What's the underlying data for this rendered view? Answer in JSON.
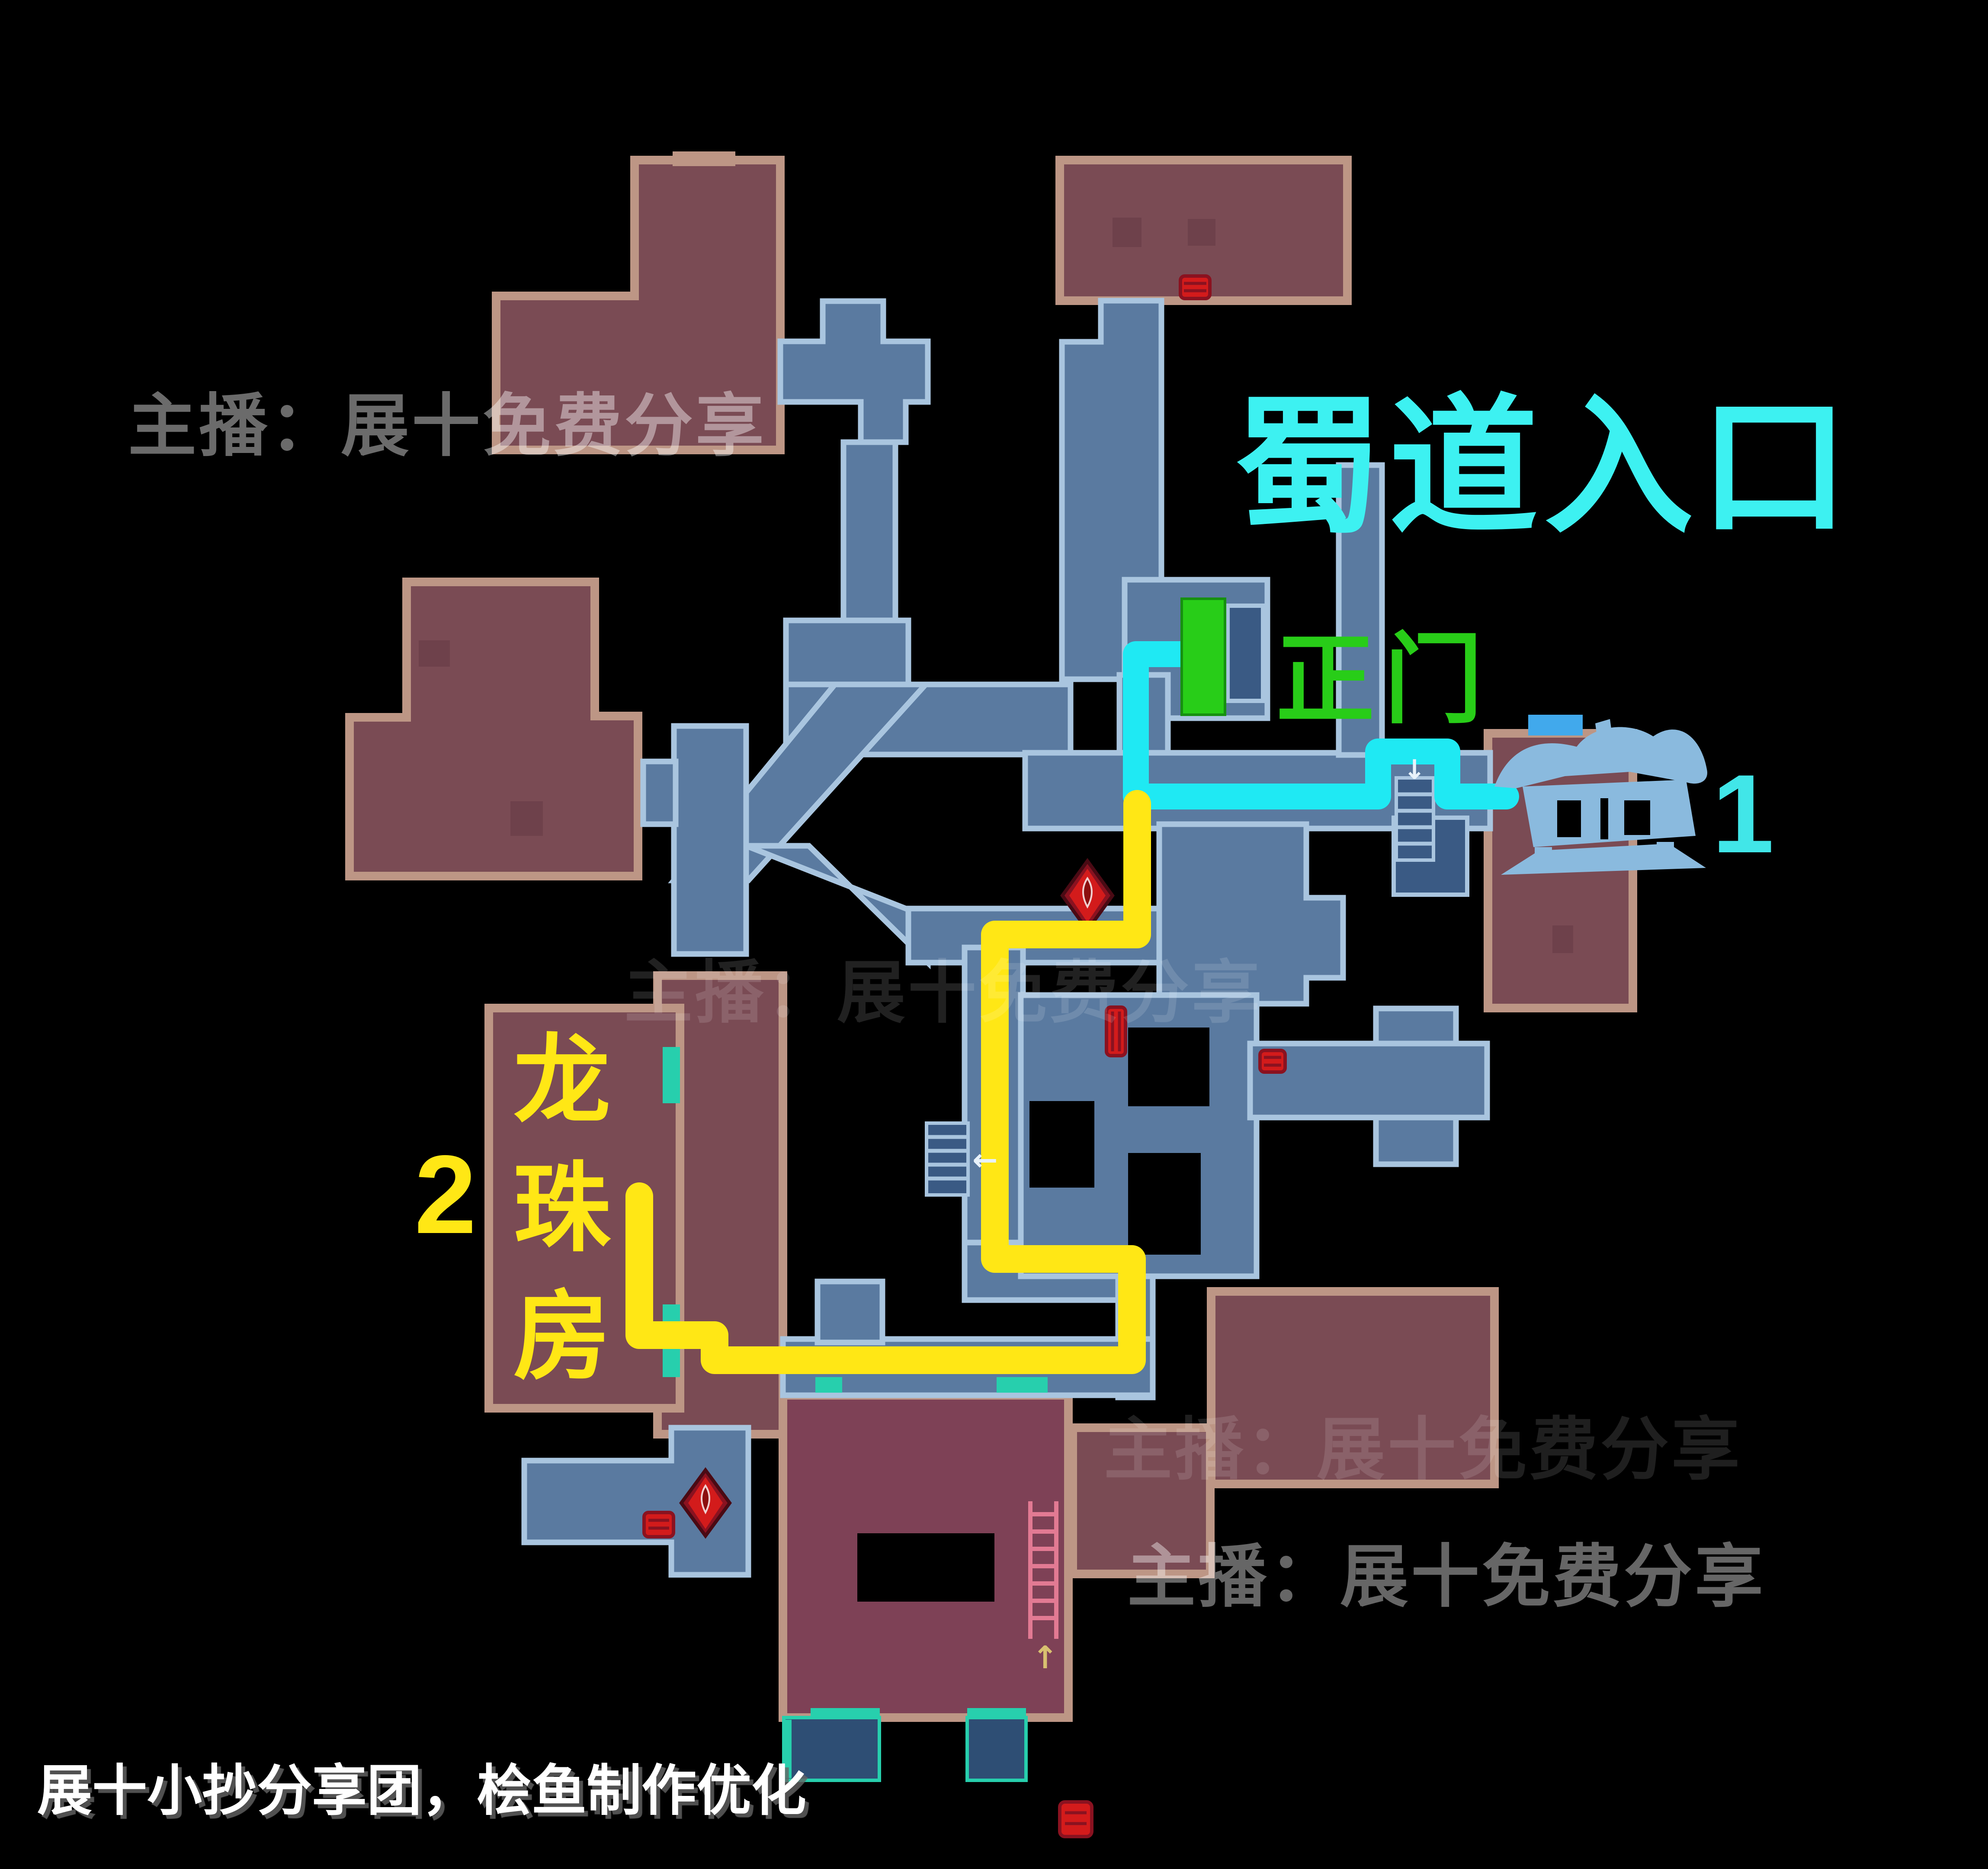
{
  "colors": {
    "bg": "#000000",
    "roomRed": "#7a4b54",
    "roomRedDeep": "#7e4156",
    "roomRedDark": "#6e414b",
    "wallTan": "#bd9685",
    "roomBlue": "#5a7aa0",
    "roomBlueDark": "#3a5a84",
    "roomBlueDeep": "#2e4e74",
    "wallBlue": "#a9c5df",
    "brightBlue": "#41a9ec",
    "teal": "#27cfad",
    "cyan": "#1fe9f3",
    "titleCyan": "#3df1f1",
    "numCyan": "#41e6e8",
    "yellow": "#ffe715",
    "green": "#28cd18",
    "red": "#d31b1b",
    "redDark": "#8a1220",
    "lantern": "#8abade",
    "ladderPink": "#e27a93"
  },
  "title": "蜀道入口",
  "gate_label": "正门",
  "marker1_label": "1",
  "marker2_label": "2",
  "room_label": {
    "full": "龙珠房",
    "chars": [
      "龙",
      "珠",
      "房"
    ]
  },
  "watermark_text": "主播：展十免费分享",
  "credit_text": "展十小抄分享团，桧鱼制作优化",
  "routes": {
    "cyan": "2752,1512 2626,1512 2626,1841 3186,1841 3186,1737 3346,1737 3346,1841 3482,1841",
    "yellow": "2629,1858 2629,2160 2300,2160 2300,2910 2617,2910 2617,3144 1652,3144 1652,3086 1478,3086 1478,2765"
  },
  "icons": {
    "arrow_left": "←",
    "arrow_up": "↑",
    "arrow_down": "↓"
  }
}
